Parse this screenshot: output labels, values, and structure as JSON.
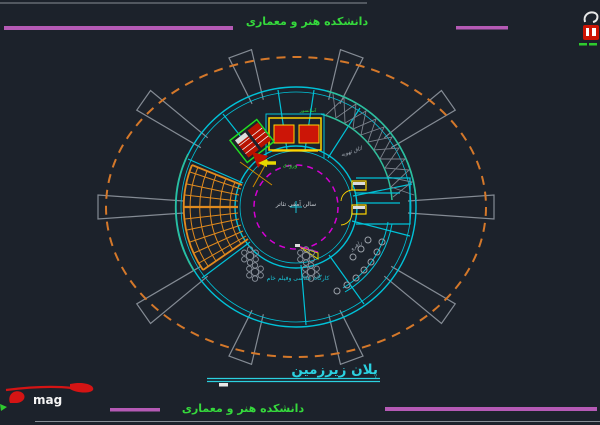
{
  "meta": {
    "background": "#1c222b",
    "drawing_type": "architectural-cad-plan"
  },
  "header": {
    "project_text": "دانشکده هنر و معماری",
    "colors": {
      "magenta_rule": "#b55ab5",
      "green_text": "#35d93c",
      "gray_rule": "#878d95"
    }
  },
  "plan": {
    "labels": {
      "center_hall": "سالن آمفی تئاتر",
      "photo_workshop": "کارگاه عکاسی وفیلم خام",
      "vent_room": "اتاق تهویه",
      "corridor": "راهرو",
      "entrance": "ورودی",
      "elevator": "آسانسور"
    },
    "colors": {
      "wall_cyan": "#00c2d8",
      "axis_magenta": "#d400d4",
      "boundary_orange": "#d4782a",
      "stair_orange": "#e08a1e",
      "structure_gray": "#848b94",
      "teal_green": "#2fbf9b",
      "block_yellow": "#ffd400",
      "block_red": "#cc1507",
      "stair_green": "#22dd22",
      "center_text": "#c9ced4"
    }
  },
  "title_block": {
    "title": "پلان زیرزمین",
    "title_color": "#2bd1e0"
  },
  "footer": {
    "project_text": "دانشکده هنر و معماری",
    "logo_text": "mag",
    "logo_red": "#d41414"
  }
}
